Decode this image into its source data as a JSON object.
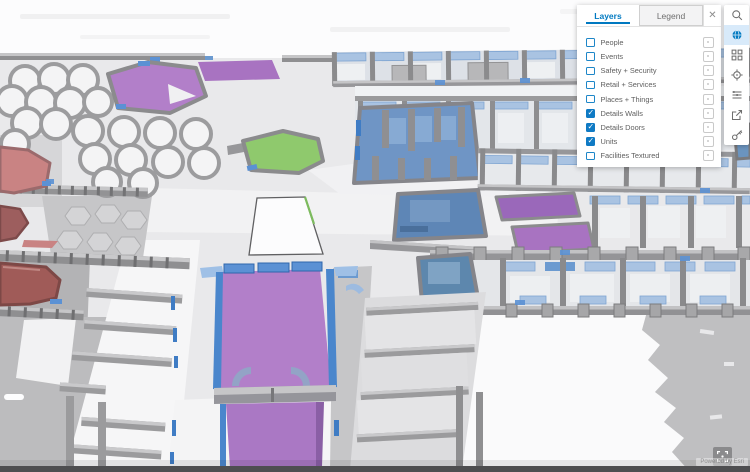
{
  "app": {
    "name": "Indoors 3D scene viewer"
  },
  "panel": {
    "tabs": [
      {
        "label": "Layers",
        "active": true
      },
      {
        "label": "Legend",
        "active": false
      }
    ],
    "close_label": "✕",
    "layers": [
      {
        "label": "People",
        "checked": false
      },
      {
        "label": "Events",
        "checked": false
      },
      {
        "label": "Safety + Security",
        "checked": false
      },
      {
        "label": "Retail + Services",
        "checked": false
      },
      {
        "label": "Places + Things",
        "checked": false
      },
      {
        "label": "Details Walls",
        "checked": true
      },
      {
        "label": "Details Doors",
        "checked": true
      },
      {
        "label": "Units",
        "checked": true
      },
      {
        "label": "Facilities Textured",
        "checked": false
      }
    ]
  },
  "toolbar": {
    "items": [
      {
        "name": "search",
        "icon": "search",
        "active": false
      },
      {
        "name": "layers-widget",
        "icon": "globe",
        "active": true
      },
      {
        "name": "basemap",
        "icon": "basemap-grid",
        "active": false
      },
      {
        "name": "locate",
        "icon": "locate-crosshair",
        "active": false
      },
      {
        "name": "levels",
        "icon": "levels",
        "active": false
      },
      {
        "name": "share",
        "icon": "export",
        "active": false
      },
      {
        "name": "credentials",
        "icon": "key",
        "active": false
      }
    ]
  },
  "attribution": {
    "text": "Powered by Esri"
  },
  "colors": {
    "accent": "#0079c1",
    "unitPurple": "#b27fc9",
    "unitPurpleFlat": "#a873c1",
    "unitPurpleDeep": "#9a68ba",
    "unitGreen": "#8fc96d",
    "unitSalmon": "#c98383",
    "unitDarkRed": "#a05b58",
    "roomBlue": "#6f95c5",
    "roomSteelBlue": "#5e86b6",
    "roomTeal": "#5d87ad",
    "doorBlue": "#5b91d4",
    "windowBlue": "#a9c3e2"
  }
}
